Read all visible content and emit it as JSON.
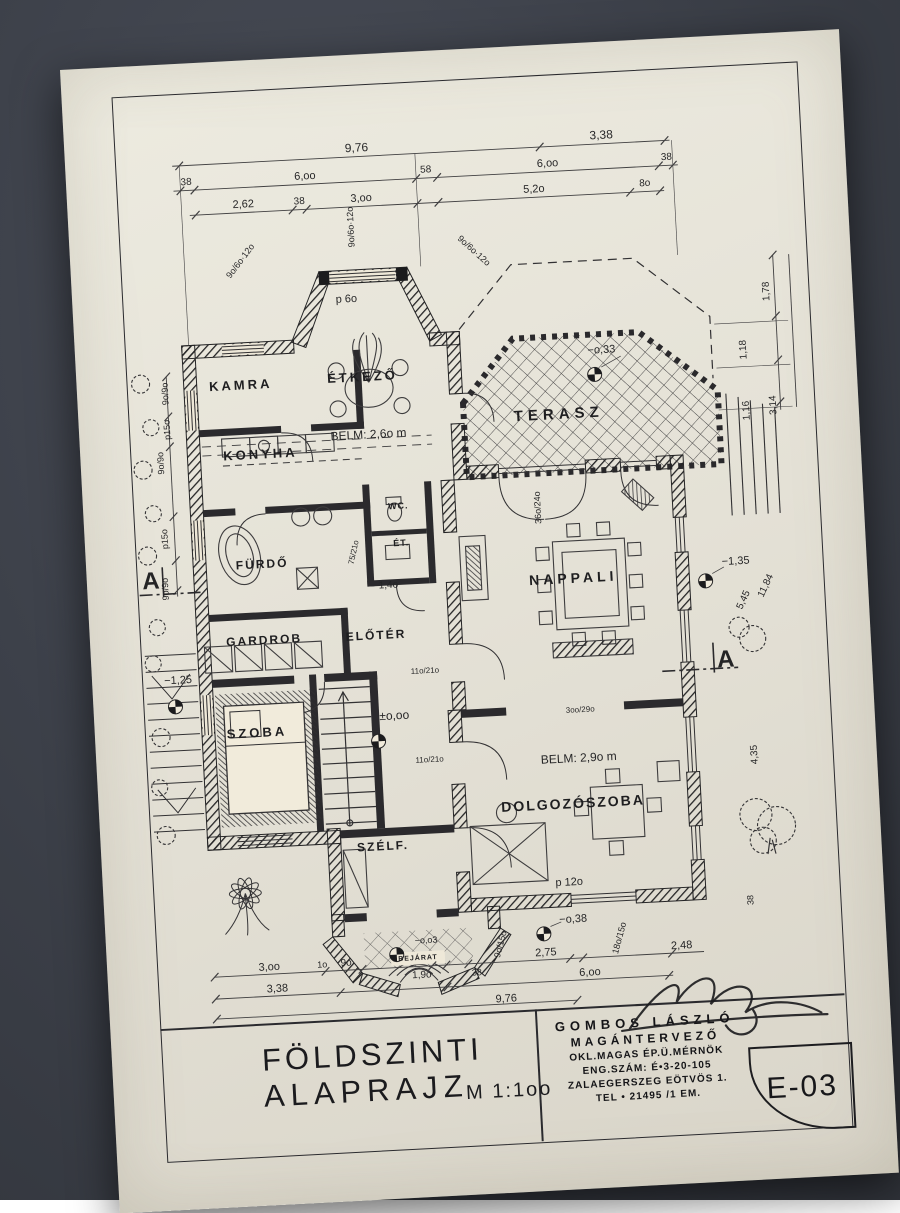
{
  "colors": {
    "paper": "#e5e2d7",
    "background": "#3d414a",
    "ink": "#222226"
  },
  "title": {
    "line1": "FÖLDSZINTI",
    "line2": "ALAPRAJZ",
    "scale": "M 1:1oo"
  },
  "title_block": {
    "architect": "GOMBOS LÁSZLÓ",
    "role": "MAGÁNTERVEZŐ",
    "credentials": "OKL.MAGAS ÉP.Ü.MÉRNÖK",
    "license": "ENG.SZÁM: É•3-20-105",
    "address": "ZALAEGERSZEG EÖTVÖS 1.",
    "phone": "TEL • 21495  /1 EM.",
    "sheet_number": "E-03"
  },
  "plan": {
    "labels": [
      {
        "n": "dim-top",
        "t": "9,76",
        "x": 240,
        "y": 61,
        "s": 12
      },
      {
        "n": "dim-top",
        "t": "3,38",
        "x": 485,
        "y": 61,
        "s": 12
      },
      {
        "n": "dim-top",
        "t": "38",
        "x": 68,
        "y": 87,
        "s": 10
      },
      {
        "n": "dim-top",
        "t": "6,oo",
        "x": 187,
        "y": 87,
        "s": 11
      },
      {
        "n": "dim-top",
        "t": "58",
        "x": 308,
        "y": 87,
        "s": 10
      },
      {
        "n": "dim-top",
        "t": "6,oo",
        "x": 430,
        "y": 87,
        "s": 11
      },
      {
        "n": "dim-top",
        "t": "38",
        "x": 549,
        "y": 87,
        "s": 10
      },
      {
        "n": "dim-top",
        "t": "2,62",
        "x": 124,
        "y": 112,
        "s": 11
      },
      {
        "n": "dim-top",
        "t": "38",
        "x": 180,
        "y": 112,
        "s": 10
      },
      {
        "n": "dim-top",
        "t": "3,oo",
        "x": 242,
        "y": 112,
        "s": 11
      },
      {
        "n": "dim-top",
        "t": "5,2o",
        "x": 415,
        "y": 112,
        "s": 11
      },
      {
        "n": "dim-top",
        "t": "8o",
        "x": 526,
        "y": 112,
        "s": 10
      },
      {
        "n": "window-note",
        "t": "9o/6o·12o",
        "x": 118,
        "y": 168,
        "r": -50,
        "s": 9
      },
      {
        "n": "window-note",
        "t": "9o/6o·12o",
        "x": 352,
        "y": 170,
        "r": 45,
        "s": 9
      },
      {
        "n": "window-note",
        "t": "9o/6o·12o",
        "x": 230,
        "y": 140,
        "r": -90,
        "s": 9
      },
      {
        "n": "parapet-note",
        "t": "p 6o",
        "x": 222,
        "y": 212,
        "s": 11
      },
      {
        "n": "window-note",
        "t": "9o/9o",
        "x": 36,
        "y": 297,
        "r": -90,
        "s": 9
      },
      {
        "n": "parapet-note",
        "t": "p15o",
        "x": 36,
        "y": 333,
        "r": -90,
        "s": 9
      },
      {
        "n": "window-note",
        "t": "9o/9o",
        "x": 28,
        "y": 366,
        "r": -90,
        "s": 9
      },
      {
        "n": "parapet-note",
        "t": "p15o",
        "x": 28,
        "y": 442,
        "r": -90,
        "s": 9
      },
      {
        "n": "window-note",
        "t": "9o/9o",
        "x": 26,
        "y": 492,
        "r": -90,
        "s": 9
      },
      {
        "n": "section-marker-a-left",
        "t": "A",
        "x": 12,
        "y": 484,
        "s": 24,
        "c": "sec"
      },
      {
        "n": "level-label",
        "t": "−1,25",
        "x": 34,
        "y": 584,
        "s": 11
      },
      {
        "n": "dim-right",
        "t": "1,78",
        "x": 642,
        "y": 226,
        "r": -90,
        "s": 10
      },
      {
        "n": "dim-right",
        "t": "1,18",
        "x": 616,
        "y": 283,
        "r": -90,
        "s": 10
      },
      {
        "n": "dim-right",
        "t": "1,16",
        "x": 616,
        "y": 344,
        "r": -90,
        "s": 10
      },
      {
        "n": "dim-right",
        "t": "3,14",
        "x": 643,
        "y": 340,
        "r": -90,
        "s": 10
      },
      {
        "n": "dim-right",
        "t": "11,84",
        "x": 626,
        "y": 520,
        "r": -62,
        "s": 10
      },
      {
        "n": "dim-right",
        "t": "5,45",
        "x": 603,
        "y": 533,
        "r": -62,
        "s": 10
      },
      {
        "n": "dim-right",
        "t": "4,35",
        "x": 606,
        "y": 688,
        "r": -90,
        "s": 10
      },
      {
        "n": "dim-right",
        "t": "38",
        "x": 594,
        "y": 833,
        "r": -90,
        "s": 9
      },
      {
        "n": "section-marker-a-right",
        "t": "A",
        "x": 582,
        "y": 592,
        "s": 24,
        "c": "sec"
      },
      {
        "n": "level-label",
        "t": "−o,33",
        "x": 474,
        "y": 276,
        "s": 11
      },
      {
        "n": "level-label",
        "t": "±o,oo",
        "x": 248,
        "y": 630,
        "s": 12
      },
      {
        "n": "level-label",
        "t": "−o,38",
        "x": 416,
        "y": 843,
        "s": 11
      },
      {
        "n": "level-label",
        "t": "−1,35",
        "x": 597,
        "y": 494,
        "s": 11
      },
      {
        "n": "level-label",
        "t": "−o,o3",
        "x": 268,
        "y": 856,
        "s": 9
      },
      {
        "n": "dim-bottom",
        "t": "3,oo",
        "x": 110,
        "y": 875,
        "s": 11
      },
      {
        "n": "dim-bottom",
        "t": "1o",
        "x": 163,
        "y": 875,
        "s": 9
      },
      {
        "n": "dim-bottom",
        "t": "9o",
        "x": 187,
        "y": 875,
        "s": 10
      },
      {
        "n": "dim-bottom",
        "t": "1,9o",
        "x": 262,
        "y": 891,
        "s": 10
      },
      {
        "n": "dim-bottom",
        "t": "38",
        "x": 317,
        "y": 891,
        "s": 9
      },
      {
        "n": "dim-bottom",
        "t": "9o/15o",
        "x": 342,
        "y": 864,
        "r": -72,
        "s": 9
      },
      {
        "n": "dim-bottom",
        "t": "2,75",
        "x": 387,
        "y": 875,
        "s": 11
      },
      {
        "n": "dim-bottom",
        "t": "18o/15o",
        "x": 461,
        "y": 864,
        "r": -72,
        "s": 9
      },
      {
        "n": "dim-bottom",
        "t": "2,48",
        "x": 523,
        "y": 875,
        "s": 11
      },
      {
        "n": "dim-bottom",
        "t": "3,38",
        "x": 117,
        "y": 897,
        "s": 11
      },
      {
        "n": "dim-bottom",
        "t": "6,oo",
        "x": 430,
        "y": 897,
        "s": 11
      },
      {
        "n": "dim-bottom",
        "t": "9,76",
        "x": 345,
        "y": 919,
        "s": 11
      },
      {
        "n": "ceiling-height-note",
        "t": "BELM: 2,6o m",
        "x": 237,
        "y": 348,
        "s": 12
      },
      {
        "n": "ceiling-height-note",
        "t": "BELM: 2,9o m",
        "x": 430,
        "y": 682,
        "s": 12
      },
      {
        "n": "parapet-note",
        "t": "p 12o",
        "x": 414,
        "y": 806,
        "s": 11
      },
      {
        "n": "dim-note",
        "t": "1,4o",
        "x": 249,
        "y": 500,
        "s": 10
      },
      {
        "n": "door-size-note",
        "t": "11o/21o",
        "x": 281,
        "y": 587,
        "s": 8
      },
      {
        "n": "door-size-note",
        "t": "11o/21o",
        "x": 281,
        "y": 676,
        "s": 8
      },
      {
        "n": "door-size-note",
        "t": "36o/24o",
        "x": 402,
        "y": 430,
        "r": -90,
        "s": 9
      },
      {
        "n": "door-size-note",
        "t": "3oo/29o",
        "x": 434,
        "y": 634,
        "s": 8
      },
      {
        "n": "door-size-note",
        "t": "75/21o",
        "x": 216,
        "y": 465,
        "r": -75,
        "s": 8
      },
      {
        "n": "room-label-kamra",
        "t": "KAMRA",
        "x": 112,
        "y": 292,
        "s": 13,
        "ls": 3,
        "c": "room"
      },
      {
        "n": "room-label-etkezo",
        "t": "ÉTKEZŐ",
        "x": 234,
        "y": 290,
        "s": 13,
        "ls": 3,
        "c": "room"
      },
      {
        "n": "room-label-konyha",
        "t": "KONYHA",
        "x": 128,
        "y": 362,
        "s": 13,
        "ls": 3,
        "c": "room"
      },
      {
        "n": "room-label-terasz",
        "t": "TERASZ",
        "x": 428,
        "y": 338,
        "s": 15,
        "ls": 5,
        "c": "room"
      },
      {
        "n": "room-label-furdo",
        "t": "FÜRDŐ",
        "x": 124,
        "y": 472,
        "s": 12,
        "ls": 2,
        "c": "room"
      },
      {
        "n": "room-label-wc",
        "t": "WC.",
        "x": 263,
        "y": 421,
        "s": 9,
        "ls": 1,
        "c": "room"
      },
      {
        "n": "room-label-et",
        "t": "ÉT.",
        "x": 264,
        "y": 458,
        "s": 9,
        "ls": 1,
        "c": "room"
      },
      {
        "n": "room-label-gardrob",
        "t": "GARDROB",
        "x": 122,
        "y": 548,
        "s": 12,
        "ls": 2,
        "c": "room"
      },
      {
        "n": "room-label-eloter",
        "t": "ELŐTÉR",
        "x": 234,
        "y": 549,
        "s": 12,
        "ls": 2,
        "c": "room"
      },
      {
        "n": "room-label-nappali",
        "t": "NAPPALI",
        "x": 434,
        "y": 502,
        "s": 14,
        "ls": 4,
        "c": "room"
      },
      {
        "n": "room-label-szoba",
        "t": "SZOBA",
        "x": 110,
        "y": 640,
        "s": 13,
        "ls": 3,
        "c": "room"
      },
      {
        "n": "room-label-szelfogo",
        "t": "SZÉLF.",
        "x": 230,
        "y": 760,
        "s": 12,
        "ls": 2,
        "c": "room"
      },
      {
        "n": "room-label-dolgozoszoba",
        "t": "DOLGOZÓSZOBA",
        "x": 422,
        "y": 727,
        "s": 14,
        "ls": 2,
        "c": "room"
      },
      {
        "n": "room-label-bejarat",
        "t": "BEJÁRAT",
        "x": 259,
        "y": 874,
        "s": 7,
        "ls": 1,
        "c": "room"
      }
    ]
  }
}
